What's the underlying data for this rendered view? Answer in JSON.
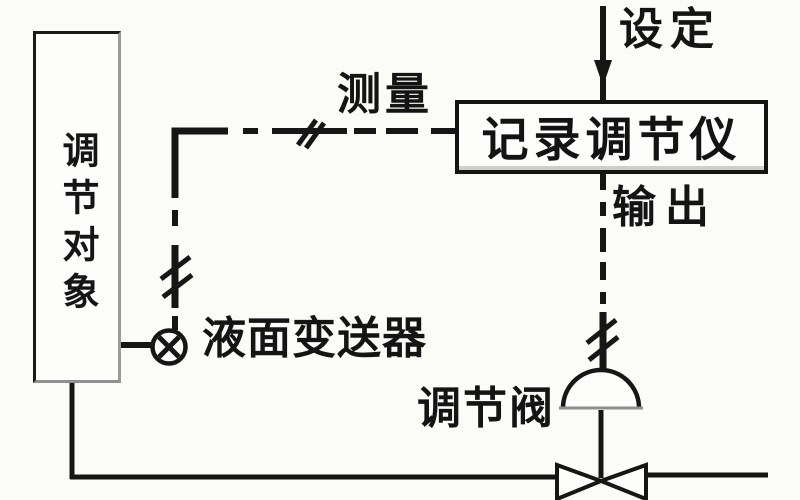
{
  "diagram": {
    "type": "process-control-loop-block-diagram",
    "controlled_object": {
      "label": "调节对象"
    },
    "transmitter": {
      "label": "液面变送器",
      "symbol": "circle-x-transmitter"
    },
    "measurement": {
      "label": "测量",
      "line_style": "dash-dot-with-slash-ticks"
    },
    "controller": {
      "label": "记录调节仪"
    },
    "setpoint": {
      "label": "设定",
      "arrow": "down-into-controller"
    },
    "output": {
      "label": "输出",
      "line_style": "dashed-with-slash-ticks"
    },
    "valve": {
      "label": "调节阀",
      "symbol": "dome-actuator-on-bowtie-valve-body"
    },
    "pipe": {
      "description": "bottom process pipe through valve body"
    }
  },
  "colors": {
    "ink": "#161616",
    "paper": "#fbfbf8",
    "scan_gray": "#8f8f8f"
  }
}
